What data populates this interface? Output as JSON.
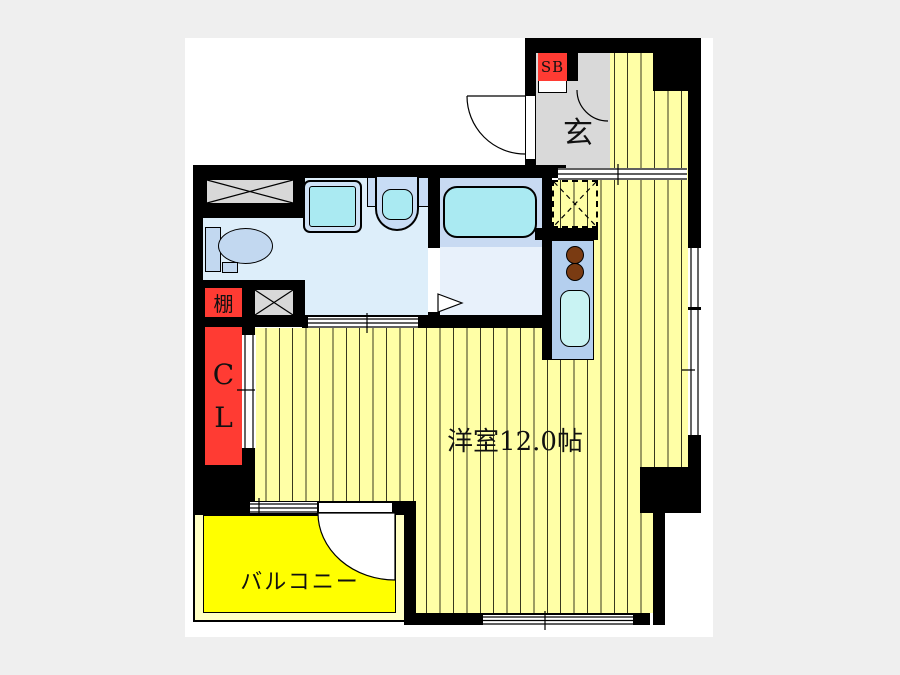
{
  "plan": {
    "title": "apartment-floor-plan",
    "rooms": {
      "main_room": {
        "label": "洋室12.0帖"
      },
      "entrance": {
        "label": "玄"
      },
      "shoe_box": {
        "label": "SB"
      },
      "shelf": {
        "label": "棚"
      },
      "closet": {
        "line1": "C",
        "line2": "L"
      },
      "balcony": {
        "label": "バルコニー"
      }
    },
    "fixtures": [
      "washing-machine-pan-icon",
      "toilet-icon",
      "vanity-sink-icon",
      "wash-basin-icon",
      "bathtub-icon",
      "kitchen-stove-icon",
      "kitchen-sink-icon",
      "dashed-storage-icon",
      "door-swing-arc-icon",
      "sliding-window-icon"
    ],
    "colors": {
      "wall": "#000000",
      "floor_stripe_yellow": "#ffffa6",
      "balcony_yellow": "#ffff00",
      "balcony_margin": "#ffffc4",
      "label_red": "#ff3b33",
      "entrance_gray": "#d9d9d9",
      "washroom_blue": "#ddeefa",
      "bath_blue": "#c8daf2",
      "fixture_cyan": "#aaeaf2",
      "counter_blue": "#b4cfee",
      "burner_brown": "#7a3b12"
    }
  }
}
